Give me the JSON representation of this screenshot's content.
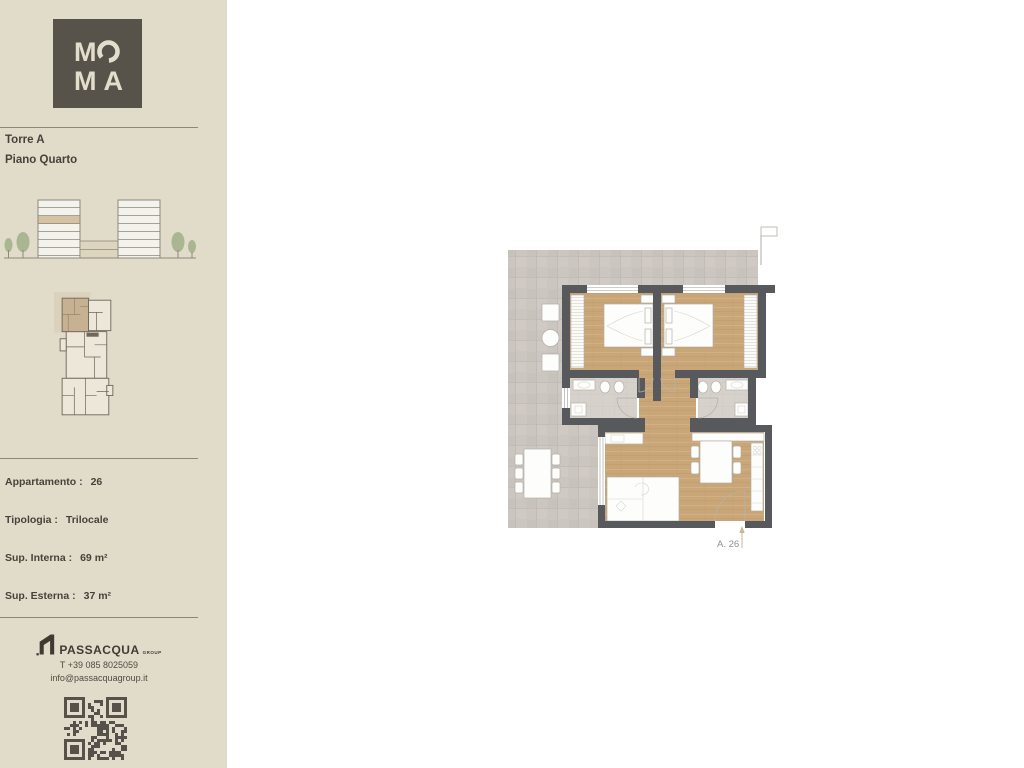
{
  "brand": {
    "logo_top_m": "M",
    "logo_bottom": "MA"
  },
  "sidebar": {
    "tower": "Torre A",
    "floor": "Piano Quarto",
    "details": [
      {
        "label": "Appartamento :",
        "value": "26"
      },
      {
        "label": "Tipologia :",
        "value": "Trilocale"
      },
      {
        "label": "Sup. Interna :",
        "value": "69 m²"
      },
      {
        "label": "Sup. Esterna :",
        "value": "37 m²"
      }
    ],
    "contact": {
      "brand": "PASSACQUA",
      "brand_suffix": "GROUP",
      "phone": "T +39 085 8025059",
      "email": "info@passacquagroup.it"
    }
  },
  "plan": {
    "unit_label": "A. 26"
  },
  "colors": {
    "sidebar-bg": "#e1dcca",
    "logo-bg": "#57524a",
    "ink": "#46423a",
    "divider": "#8c8779",
    "wall": "#58595c",
    "wood": "#c9a678",
    "terrace": "#ccc6c0",
    "bath": "#d6d2cb",
    "highlight": "#d5c2a2",
    "tree": "#a9b691",
    "label-gray": "#908e89"
  }
}
